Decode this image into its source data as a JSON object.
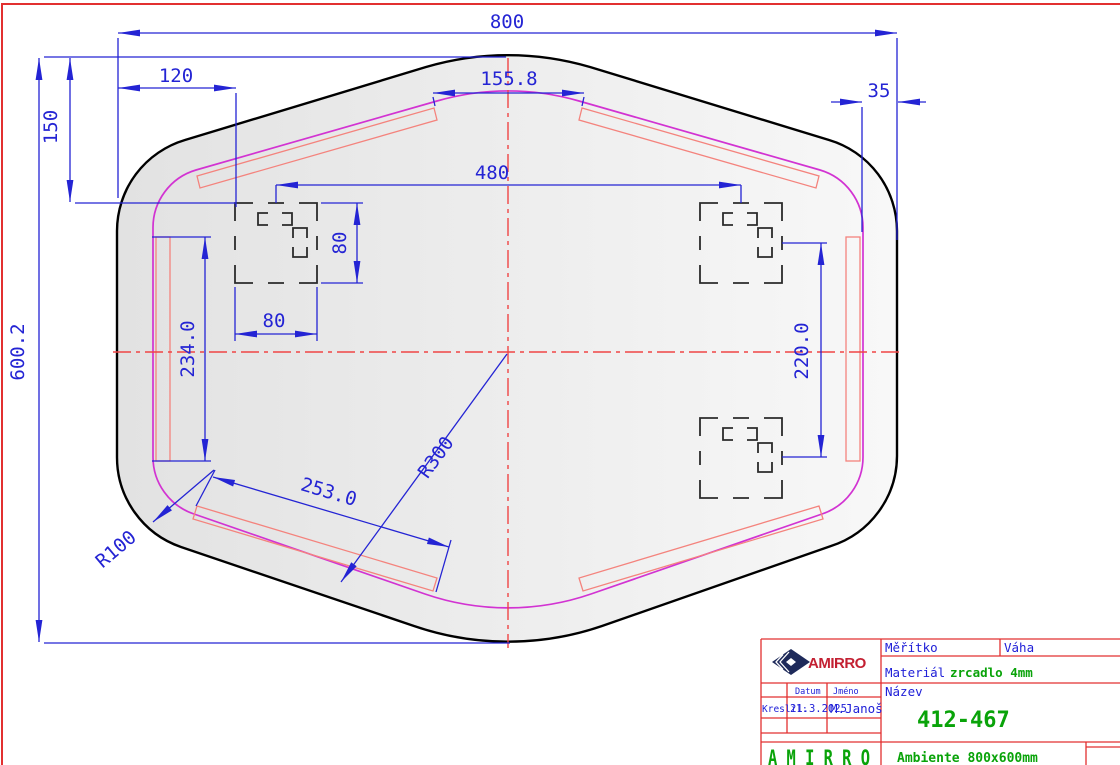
{
  "drawing": {
    "dims": {
      "total_width": "800",
      "total_height": "600.2",
      "top_to_bracket": "150",
      "left_to_bracket": "120",
      "top_gap": "155.8",
      "edge_inset": "35",
      "bracket_centers_h": "480",
      "bracket_w": "80",
      "bracket_h": "80",
      "left_strip_length": "234.0",
      "bottom_strip_length": "253.0",
      "right_bracket_centers": "220.0",
      "radius_bottom": "R300",
      "radius_corner": "R100"
    }
  },
  "title_block": {
    "scale_label": "Měřítko",
    "weight_label": "Váha",
    "material_label": "Materiál",
    "material_value": "zrcadlo 4mm",
    "name_label": "Název",
    "drawing_number": "412-467",
    "drawn_label": "Kreslil:",
    "date_label": "Datum",
    "date_value": "21.3.2025",
    "author_label": "Jméno",
    "author_value": "M.Janoš",
    "brand": "AMIRRO",
    "brand_footer": "A M I R R O",
    "product_name": "Ambiente 800x600mm"
  },
  "colors": {
    "dimension_blue": "#2424d4",
    "centerline_red": "#f04545",
    "outline_black": "#000000",
    "inner_edge_magenta": "#d233d2",
    "led_strip_salmon": "#f4837d",
    "frame_red": "#e23030",
    "value_green": "#09a309",
    "label_blue": "#2020d8",
    "brand_red": "#c32032",
    "brand_navy": "#1e2a5a"
  }
}
